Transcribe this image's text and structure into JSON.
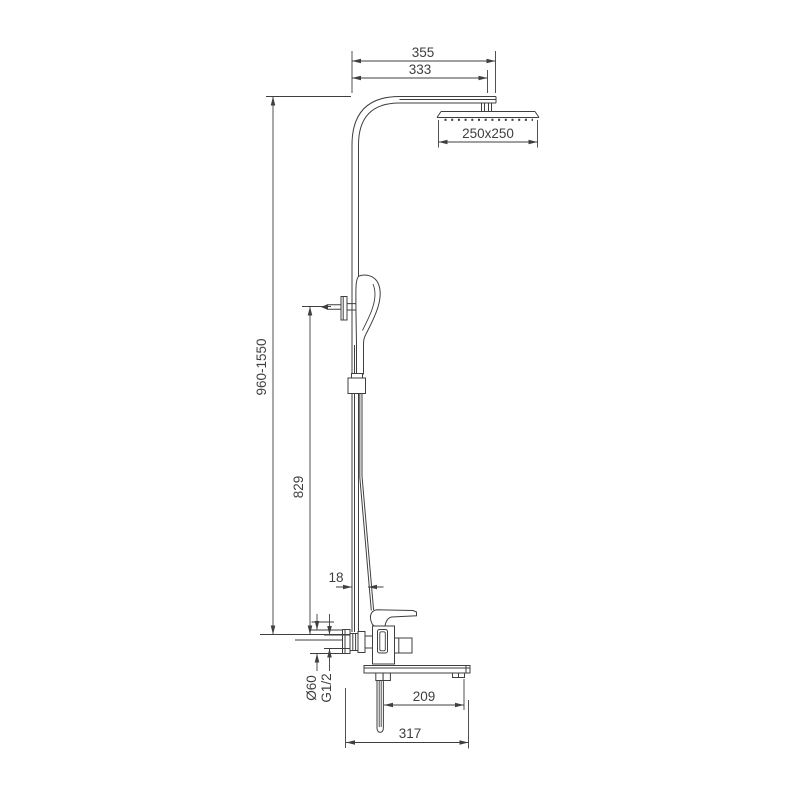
{
  "drawing": {
    "type": "technical-dimension-drawing",
    "subject": "wall-mounted shower column with rain head, hand shower and bath mixer spout",
    "colors": {
      "line": "#3f3f3f",
      "background": "#ffffff",
      "text": "#3f3f3f"
    },
    "labels": {
      "arm_overall": "355",
      "arm_to_head": "333",
      "head_size": "250x250",
      "height_range": "960-1550",
      "bracket_height": "829",
      "pipe_offset": "18",
      "escutcheon_diameter": "Ø60",
      "thread_size": "G1/2",
      "spout_reach": "209",
      "overall_reach": "317"
    }
  }
}
